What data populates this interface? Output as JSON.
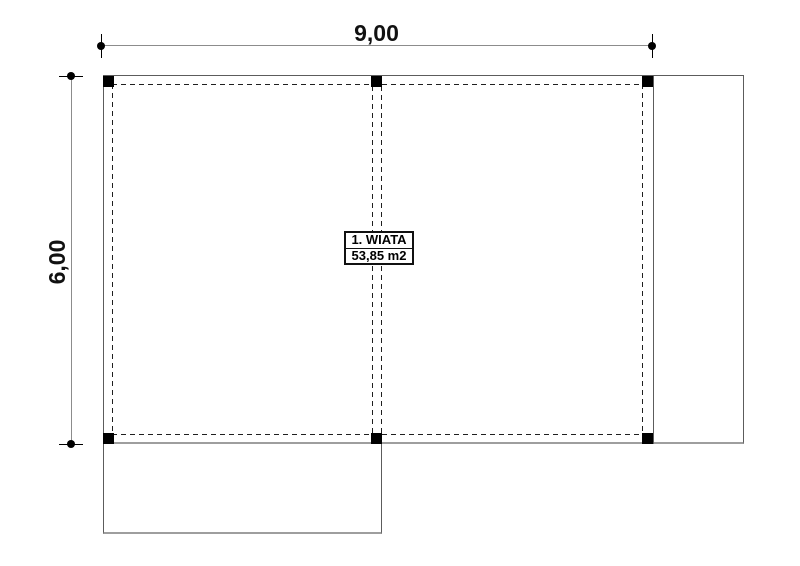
{
  "plan": {
    "room_label": "1. WIATA",
    "room_area": "53,85 m2",
    "dim_width_label": "9,00",
    "dim_height_label": "6,00"
  },
  "colors": {
    "outline": "#5c5c5c",
    "outline_light": "#9e9e9e",
    "dashed": "#1f1f1f",
    "dimension": "#8c8c8c",
    "marker": "#000000",
    "background": "#ffffff",
    "text": "#111111"
  }
}
